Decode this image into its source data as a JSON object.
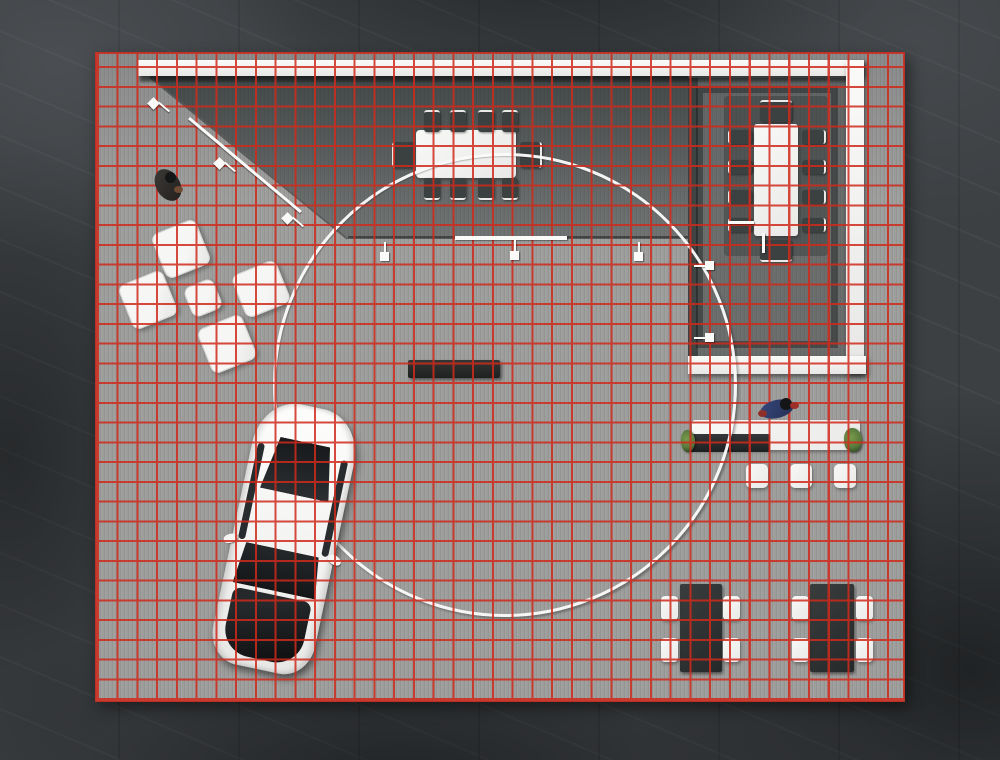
{
  "scene": {
    "title": "exhibition-booth-top-down-render",
    "surfaces": {
      "surround": "dark marble concourse",
      "floor": "light grey planked booth platform",
      "grid": {
        "cell_px": 20,
        "columns": 41,
        "rows": 33
      }
    },
    "markers": {
      "layout_ring": {
        "shape": "circle",
        "diameter_px": 464,
        "color": "#fafafa"
      }
    },
    "inventory": {
      "conference_table_chairs": 10,
      "meeting_room_chairs": 10,
      "lounge_ottomans": 5,
      "reception_stools": 3,
      "cafe_tables": 2,
      "cafe_chairs_per_table": 4,
      "display_benches": 1,
      "reception_desks": 1,
      "cars": 1,
      "people": 2,
      "spotlights": 8
    },
    "colors": {
      "marble": "#3d4043",
      "floor": "#9d9d9c",
      "grid": "#d02a1c",
      "white": "#f2f2f0",
      "furniture_dark": "#3b4040",
      "table_dark": "#323434",
      "bench_dark": "#2a2c2c",
      "glass_dark": "#1d2022",
      "plant_green": "#57793a",
      "visitor_dark": "#34312e",
      "staff_navy": "#2e3d6b",
      "staff_red": "#9c3028",
      "car_body": "#f6f6f4"
    }
  }
}
